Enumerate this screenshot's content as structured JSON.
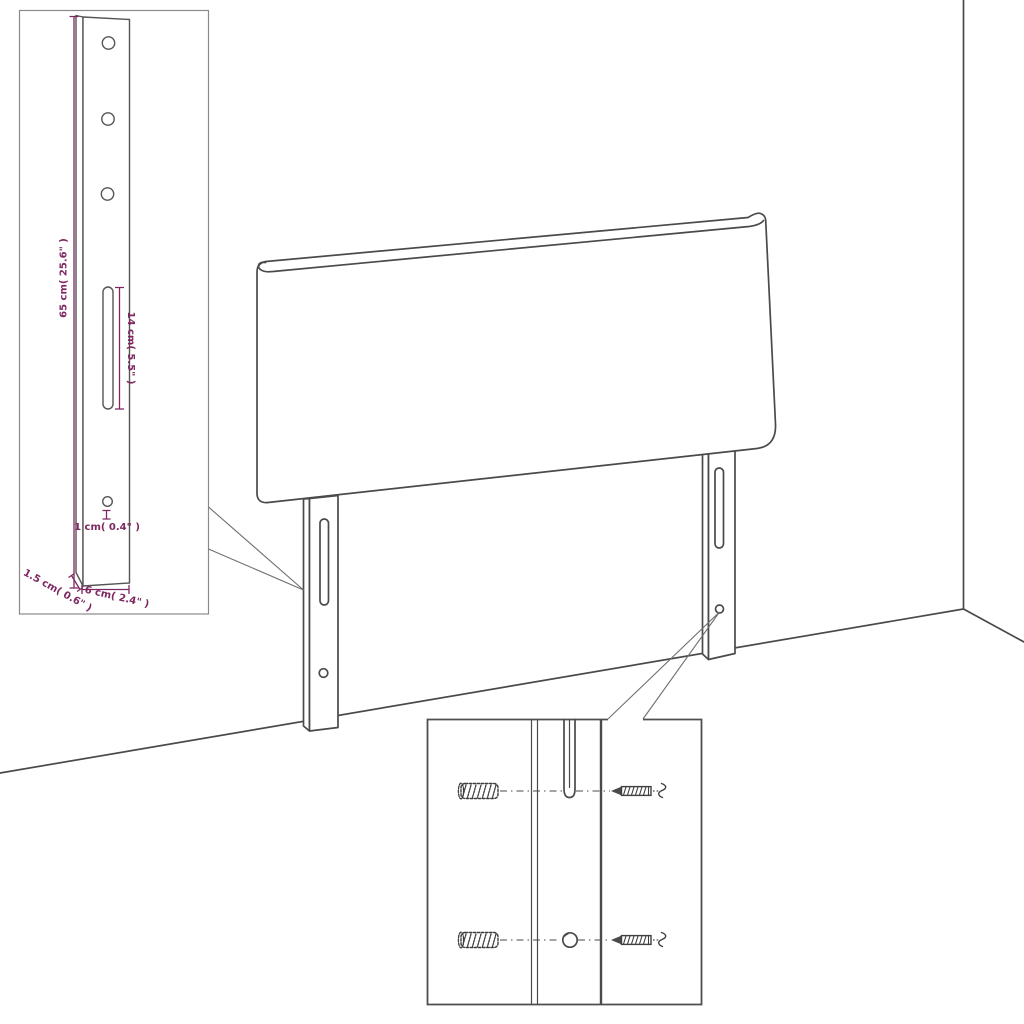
{
  "page": {
    "background": "#ffffff",
    "description": "Headboard assembly dimension diagram with leg detail inset and wall-mounting hardware inset"
  },
  "colors": {
    "line": "#4a4a4a",
    "dimension": "#7e2760",
    "inset_border_light": "#8a8a8a",
    "inset_border_dark": "#4f4f4f"
  },
  "leg_detail_inset": {
    "height_label": "65 cm( 25.6\" )",
    "slot_label": "14 cm( 5.5\" )",
    "hole_label": "1 cm( 0.4\" )",
    "depth_label": "1.5 cm( 0.6\" )",
    "width_label": "6 cm( 2.4\" )",
    "features": [
      "screw-hole-top",
      "screw-hole-middle",
      "screw-hole-lower",
      "mounting-slot",
      "small-hole"
    ]
  },
  "headboard": {
    "legs": 2,
    "slots_per_leg": 1,
    "holes_per_leg": 1
  },
  "mounting_detail_inset": {
    "rows": 2,
    "hardware": [
      "wall-plug",
      "screw"
    ],
    "targets": [
      "leg-slot",
      "leg-hole"
    ]
  }
}
